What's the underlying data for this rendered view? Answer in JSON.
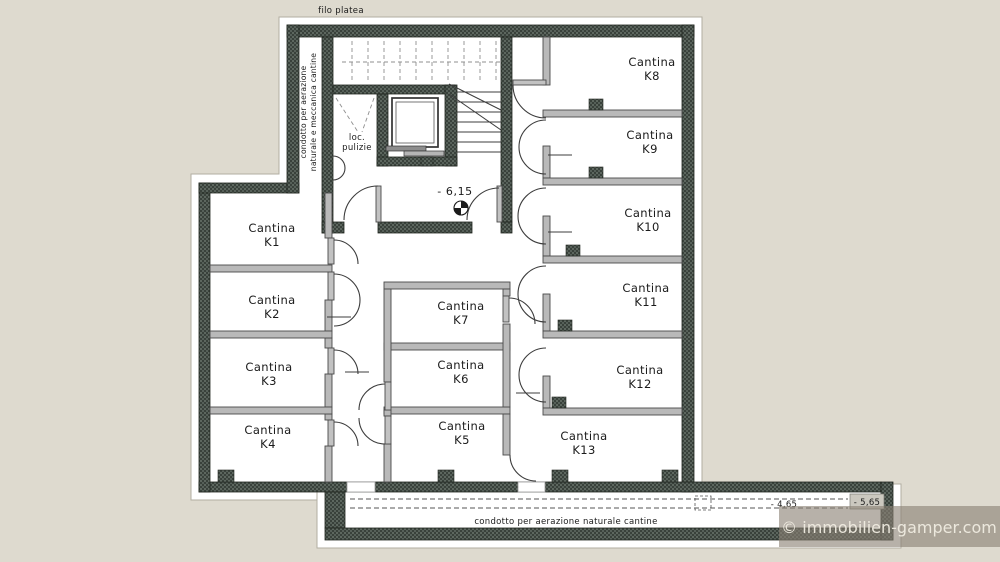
{
  "plan": {
    "top_label": "filo platea",
    "left_duct_label_line1": "condotto per aerazione",
    "left_duct_label_line2": "naturale e meccanica cantine",
    "cleaning_room_line1": "loc.",
    "cleaning_room_line2": "pulizie",
    "level_basement": "- 6,15",
    "level_duct_inner": "- 4,65",
    "level_duct_outer": "- 5,65",
    "bottom_duct_label": "condotto per aerazione naturale cantine"
  },
  "rooms": [
    {
      "name": "Cantina",
      "number": "K1"
    },
    {
      "name": "Cantina",
      "number": "K2"
    },
    {
      "name": "Cantina",
      "number": "K3"
    },
    {
      "name": "Cantina",
      "number": "K4"
    },
    {
      "name": "Cantina",
      "number": "K5"
    },
    {
      "name": "Cantina",
      "number": "K6"
    },
    {
      "name": "Cantina",
      "number": "K7"
    },
    {
      "name": "Cantina",
      "number": "K8"
    },
    {
      "name": "Cantina",
      "number": "K9"
    },
    {
      "name": "Cantina",
      "number": "K10"
    },
    {
      "name": "Cantina",
      "number": "K11"
    },
    {
      "name": "Cantina",
      "number": "K12"
    },
    {
      "name": "Cantina",
      "number": "K13"
    }
  ],
  "watermark": {
    "text": "©  immobilien-gamper.com"
  },
  "colors": {
    "background": "#dedacf",
    "wall_dark": "#39413b",
    "wall_speckle": "#5d675f",
    "partition": "#b9b9b9",
    "line": "#3c3c3c",
    "watermark_bg": "#8a8174",
    "watermark_text": "#f0ece1"
  }
}
